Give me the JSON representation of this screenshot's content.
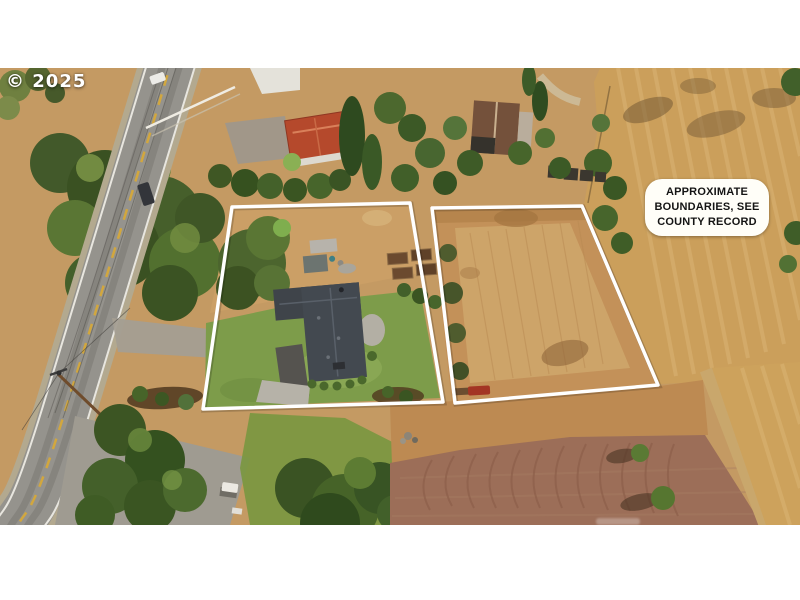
{
  "watermark": {
    "text": "© 2025"
  },
  "disclaimer": {
    "lines": [
      "APPROXIMATE",
      "BOUNDARIES, SEE",
      "COUNTY RECORD"
    ]
  },
  "colors": {
    "letterbox_bar": "#ffffff",
    "boundary_line": "#ffffff",
    "label_background": "#fffef8",
    "label_text": "#141414",
    "dry_field": "#c49a63",
    "golden_field": "#cb9f5b",
    "plowed_field": "#9c6e58",
    "lawn": "#7d9c4a",
    "trees": "#3c5523",
    "road": "#95938d",
    "house_roof": "#41464c",
    "red_roof": "#b5492c"
  }
}
